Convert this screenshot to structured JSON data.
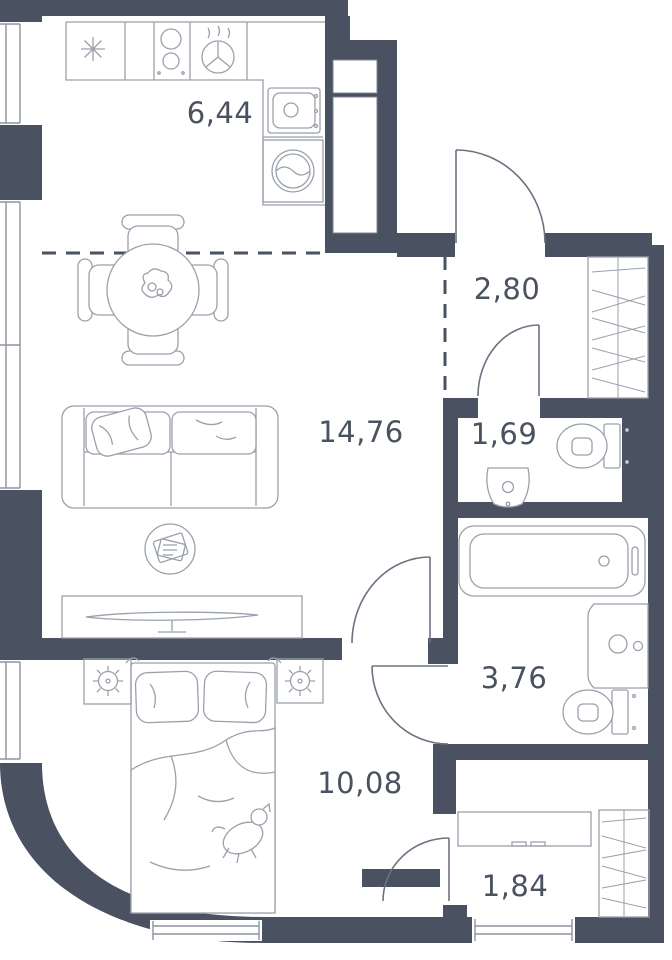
{
  "plan": {
    "type": "apartment-floor-plan",
    "rooms": [
      {
        "id": "kitchen",
        "area_m2": "6,44"
      },
      {
        "id": "living-room",
        "area_m2": "14,76"
      },
      {
        "id": "hallway",
        "area_m2": "2,80"
      },
      {
        "id": "wc",
        "area_m2": "1,69"
      },
      {
        "id": "bathroom",
        "area_m2": "3,76"
      },
      {
        "id": "bedroom",
        "area_m2": "10,08"
      },
      {
        "id": "entry-hall",
        "area_m2": "1,84"
      }
    ],
    "colors": {
      "wall": "#4a5261",
      "furniture_line": "#9aa1ab",
      "door_line": "#6b7280",
      "text": "#4a5261",
      "background": "#ffffff"
    },
    "symbols": [
      "kitchen-counter",
      "cooktop",
      "extractor-hood",
      "kitchen-sink",
      "washing-machine",
      "dining-table",
      "chair",
      "houseplant",
      "sofa",
      "throw-pillow",
      "coffee-table",
      "tv-stand",
      "tv",
      "double-bed",
      "pillows",
      "duvet",
      "dog",
      "nightstand",
      "lamp",
      "bathtub",
      "washbasin",
      "toilet",
      "wardrobe",
      "dresser",
      "entry-door",
      "interior-door",
      "window",
      "zoning-dashed-line"
    ]
  }
}
